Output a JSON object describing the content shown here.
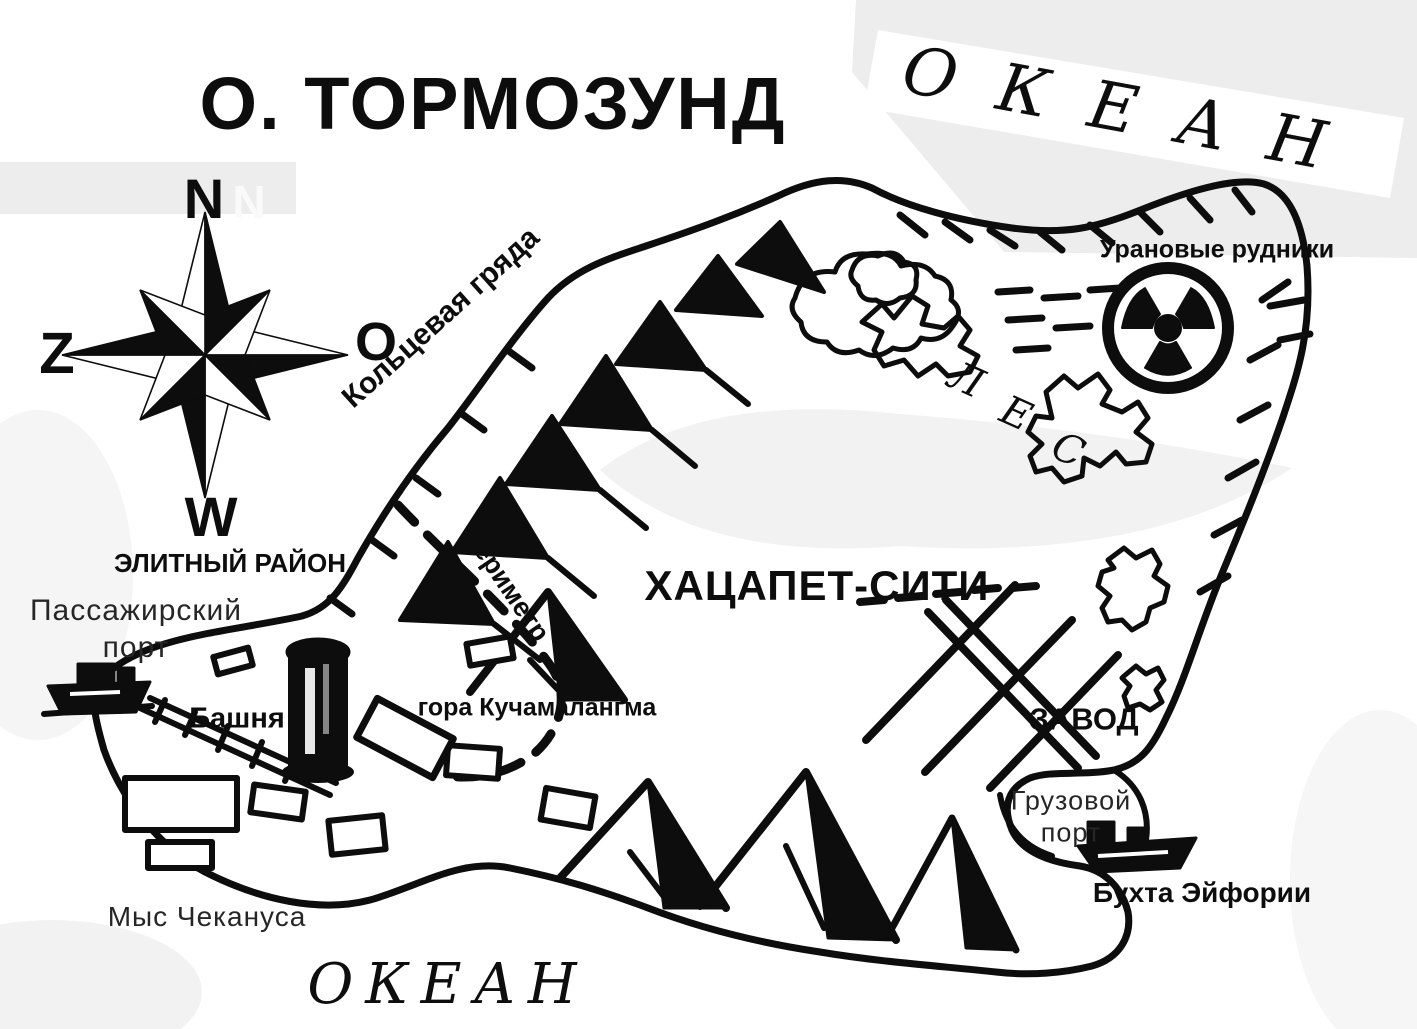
{
  "map": {
    "title": "О. ТОРМОЗУНД",
    "ocean_northeast": "ОКЕАН",
    "ocean_south": "ОКЕАН",
    "compass": {
      "north": "N",
      "north_ghost": "N",
      "west_letter": "Z",
      "east_letter": "O",
      "south_letter": "W"
    },
    "labels": {
      "ring_ridge": "Кольцевая гряда",
      "uranium_mines": "Урановые рудники",
      "forest_letter_1": "Л",
      "forest_letter_2": "Е",
      "forest_letter_3": "С",
      "city": "ХАЦАПЕТ-СИТИ",
      "elite_district": "ЭЛИТНЫЙ РАЙОН",
      "passenger_port_line1": "Пассажирский",
      "passenger_port_line2": "порт",
      "tower": "Башня",
      "perimeter": "Периметр",
      "mountain": "гора Кучамалангма",
      "factory": "ЗАВОД",
      "cargo_port_line1": "Грузовой",
      "cargo_port_line2": "порт",
      "euphoria_bay": "Бухта Эйфории",
      "cape": "Мыс Чекануса"
    },
    "colors": {
      "ink": "#0d0d0d",
      "paper": "#ffffff",
      "paper_shade": "#ededed"
    }
  }
}
